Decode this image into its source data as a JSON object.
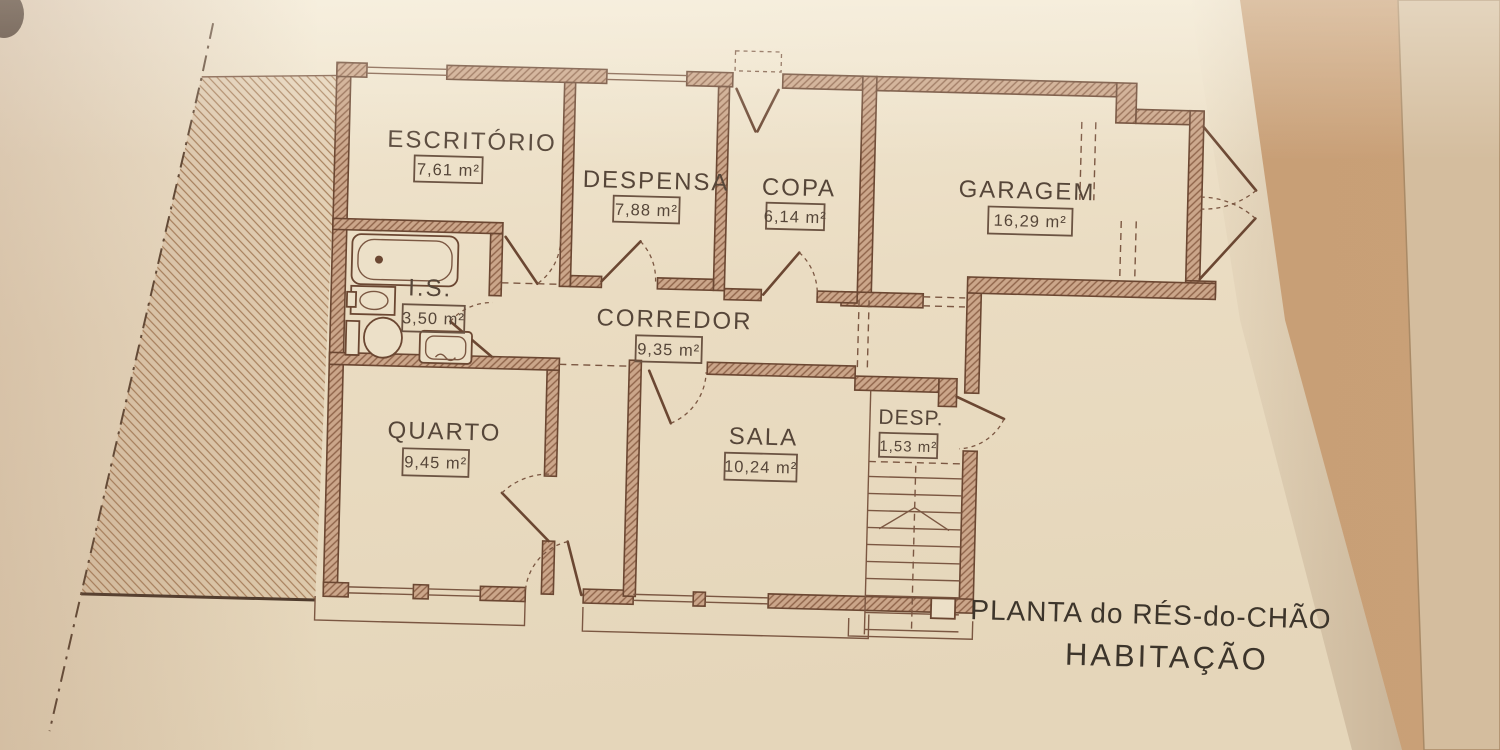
{
  "title": {
    "line1": "PLANTA do RÉS-do-CHÃO",
    "line2": "HABITAÇÃO"
  },
  "rooms": [
    {
      "id": "escritorio",
      "name": "ESCRITÓRIO",
      "area": "7,61 m²"
    },
    {
      "id": "despensa",
      "name": "DESPENSA",
      "area": "7,88 m²"
    },
    {
      "id": "copa",
      "name": "COPA",
      "area": "6,14 m²"
    },
    {
      "id": "garagem",
      "name": "GARAGEM",
      "area": "16,29 m²"
    },
    {
      "id": "is",
      "name": "I.S.",
      "area": "3,50 m²"
    },
    {
      "id": "corredor",
      "name": "CORREDOR",
      "area": "9,35 m²"
    },
    {
      "id": "quarto",
      "name": "QUARTO",
      "area": "9,45 m²"
    },
    {
      "id": "sala",
      "name": "SALA",
      "area": "10,24 m²"
    },
    {
      "id": "desp",
      "name": "DESP.",
      "area": "1,53 m²"
    }
  ],
  "colors": {
    "paper": "#ece0c8",
    "ink": "#6b4732",
    "wall_fill": "#cba68a",
    "label_text": "#564639",
    "title_text": "#3d352b",
    "background_tan": "#c39970",
    "second_sheet": "#d4bd9e"
  }
}
